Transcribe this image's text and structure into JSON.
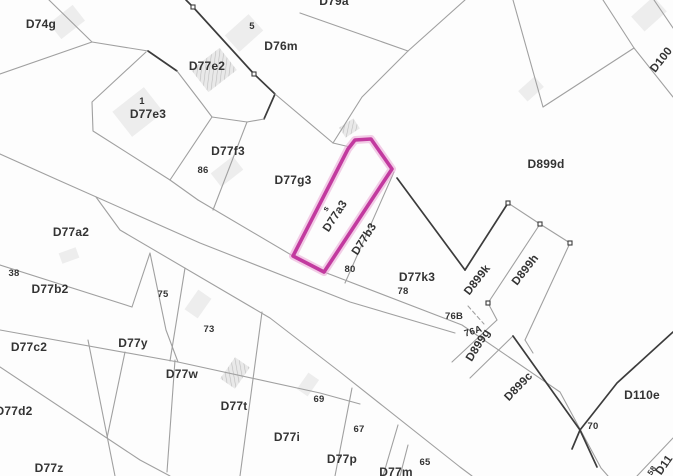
{
  "map": {
    "type": "cadastral-parcel-map",
    "background": "#fdfdfd",
    "line_color": "#a0a0a0",
    "dark_line_color": "#3c3c3c",
    "label_color": "#333333",
    "highlight": {
      "label": "D77a3",
      "stroke": "#c23a9f",
      "halo": "#e9a4d4",
      "points": [
        [
          348,
          149
        ],
        [
          355,
          140
        ],
        [
          371,
          139
        ],
        [
          392,
          169
        ],
        [
          324,
          272
        ],
        [
          293,
          256
        ]
      ]
    },
    "labels": [
      {
        "text": "D74g",
        "x": 41,
        "y": 28,
        "rot": 0,
        "size": 12
      },
      {
        "text": "D79a",
        "x": 334,
        "y": 5,
        "rot": 0,
        "size": 12
      },
      {
        "text": "5",
        "x": 252,
        "y": 29,
        "rot": 0,
        "size": 9.5
      },
      {
        "text": "D76m",
        "x": 281,
        "y": 50,
        "rot": 0,
        "size": 12
      },
      {
        "text": "D77e2",
        "x": 207,
        "y": 70,
        "rot": 0,
        "size": 12
      },
      {
        "text": "1",
        "x": 142,
        "y": 104,
        "rot": 0,
        "size": 9.5
      },
      {
        "text": "D77e3",
        "x": 148,
        "y": 118,
        "rot": 0,
        "size": 12
      },
      {
        "text": "D77f3",
        "x": 228,
        "y": 155,
        "rot": 0,
        "size": 12
      },
      {
        "text": "86",
        "x": 203,
        "y": 173,
        "rot": 0,
        "size": 9.5
      },
      {
        "text": "D77g3",
        "x": 293,
        "y": 184,
        "rot": 0,
        "size": 12
      },
      {
        "text": "D899d",
        "x": 546,
        "y": 168,
        "rot": 0,
        "size": 12
      },
      {
        "text": "D77a2",
        "x": 71,
        "y": 236,
        "rot": 0,
        "size": 12
      },
      {
        "text": "38",
        "x": 14,
        "y": 276,
        "rot": 0,
        "size": 9.5
      },
      {
        "text": "D77b2",
        "x": 50,
        "y": 293,
        "rot": 0,
        "size": 12
      },
      {
        "text": "75",
        "x": 163,
        "y": 297,
        "rot": 0,
        "size": 9.5
      },
      {
        "text": "D77a3",
        "x": 338,
        "y": 218,
        "rot": -57,
        "size": 11.5
      },
      {
        "text": "s",
        "x": 328,
        "y": 210,
        "rot": -57,
        "size": 8
      },
      {
        "text": "D77b3",
        "x": 367,
        "y": 241,
        "rot": -57,
        "size": 11.5
      },
      {
        "text": "80",
        "x": 350,
        "y": 272,
        "rot": 0,
        "size": 9.5
      },
      {
        "text": "D77k3",
        "x": 417,
        "y": 281,
        "rot": 0,
        "size": 12
      },
      {
        "text": "78",
        "x": 403,
        "y": 294,
        "rot": 0,
        "size": 9.5
      },
      {
        "text": "76B",
        "x": 454,
        "y": 319,
        "rot": 0,
        "size": 9.5
      },
      {
        "text": "76A",
        "x": 474,
        "y": 334,
        "rot": -18,
        "size": 9.5
      },
      {
        "text": "D899k",
        "x": 480,
        "y": 282,
        "rot": -52,
        "size": 11.5
      },
      {
        "text": "D899h",
        "x": 528,
        "y": 272,
        "rot": -52,
        "size": 11.5
      },
      {
        "text": "D899g",
        "x": 481,
        "y": 347,
        "rot": -58,
        "size": 11.5
      },
      {
        "text": "D899c",
        "x": 521,
        "y": 389,
        "rot": -46,
        "size": 11.5
      },
      {
        "text": "D100",
        "x": 664,
        "y": 62,
        "rot": -52,
        "size": 11.5
      },
      {
        "text": "D110e",
        "x": 642,
        "y": 399,
        "rot": 0,
        "size": 12
      },
      {
        "text": "70",
        "x": 593,
        "y": 429,
        "rot": 0,
        "size": 9.5
      },
      {
        "text": "D77c2",
        "x": 29,
        "y": 351,
        "rot": 0,
        "size": 12
      },
      {
        "text": "D77y",
        "x": 133,
        "y": 347,
        "rot": 0,
        "size": 12
      },
      {
        "text": "73",
        "x": 209,
        "y": 332,
        "rot": 0,
        "size": 9.5
      },
      {
        "text": "D77w",
        "x": 182,
        "y": 378,
        "rot": 0,
        "size": 12
      },
      {
        "text": "D77t",
        "x": 234,
        "y": 410,
        "rot": 0,
        "size": 12
      },
      {
        "text": "D77d2",
        "x": 14,
        "y": 415,
        "rot": 0,
        "size": 12
      },
      {
        "text": "69",
        "x": 319,
        "y": 402,
        "rot": 0,
        "size": 9.5
      },
      {
        "text": "D77i",
        "x": 287,
        "y": 441,
        "rot": 0,
        "size": 12
      },
      {
        "text": "67",
        "x": 359,
        "y": 432,
        "rot": 0,
        "size": 9.5
      },
      {
        "text": "D77p",
        "x": 342,
        "y": 463,
        "rot": 0,
        "size": 12
      },
      {
        "text": "65",
        "x": 425,
        "y": 465,
        "rot": 0,
        "size": 9.5
      },
      {
        "text": "D77m",
        "x": 396,
        "y": 476,
        "rot": 0,
        "size": 12
      },
      {
        "text": "D77z",
        "x": 49,
        "y": 472,
        "rot": 0,
        "size": 12
      },
      {
        "text": "58",
        "x": 654,
        "y": 472,
        "rot": -55,
        "size": 8
      },
      {
        "text": "D11",
        "x": 667,
        "y": 467,
        "rot": -55,
        "size": 11.5
      }
    ],
    "lines": [
      {
        "pts": [
          [
            49,
            0
          ],
          [
            92,
            42
          ],
          [
            148,
            51
          ]
        ]
      },
      {
        "pts": [
          [
            92,
            42
          ],
          [
            0,
            74
          ]
        ]
      },
      {
        "pts": [
          [
            148,
            51
          ],
          [
            177,
            71
          ]
        ],
        "dark": true
      },
      {
        "pts": [
          [
            177,
            71
          ],
          [
            203,
            105
          ],
          [
            212,
            117
          ]
        ]
      },
      {
        "pts": [
          [
            146,
            52
          ],
          [
            92,
            102
          ],
          [
            93,
            131
          ],
          [
            170,
            180
          ],
          [
            198,
            200
          ]
        ]
      },
      {
        "pts": [
          [
            170,
            180
          ],
          [
            212,
            117
          ]
        ]
      },
      {
        "pts": [
          [
            186,
            0
          ],
          [
            193,
            7
          ],
          [
            254,
            74
          ]
        ],
        "dark": true
      },
      {
        "pts": [
          [
            254,
            74
          ],
          [
            275,
            94
          ],
          [
            264,
            119
          ]
        ],
        "dark": true
      },
      {
        "pts": [
          [
            264,
            119
          ],
          [
            247,
            122
          ],
          [
            212,
            117
          ]
        ]
      },
      {
        "pts": [
          [
            275,
            94
          ],
          [
            333,
            143
          ],
          [
            350,
            147
          ]
        ]
      },
      {
        "pts": [
          [
            300,
            13
          ],
          [
            408,
            51
          ]
        ]
      },
      {
        "pts": [
          [
            465,
            0
          ],
          [
            408,
            51
          ]
        ]
      },
      {
        "pts": [
          [
            408,
            51
          ],
          [
            362,
            97
          ],
          [
            333,
            143
          ]
        ]
      },
      {
        "pts": [
          [
            513,
            0
          ],
          [
            543,
            107
          ]
        ]
      },
      {
        "pts": [
          [
            543,
            107
          ],
          [
            634,
            48
          ]
        ]
      },
      {
        "pts": [
          [
            634,
            48
          ],
          [
            603,
            0
          ]
        ]
      },
      {
        "pts": [
          [
            634,
            48
          ],
          [
            673,
            97
          ]
        ]
      },
      {
        "pts": [
          [
            654,
            0
          ],
          [
            673,
            28
          ]
        ]
      },
      {
        "pts": [
          [
            247,
            122
          ],
          [
            213,
            210
          ]
        ]
      },
      {
        "pts": [
          [
            198,
            200
          ],
          [
            293,
            256
          ],
          [
            324,
            272
          ],
          [
            462,
            325
          ],
          [
            560,
            392
          ],
          [
            601,
            468
          ],
          [
            608,
            476
          ]
        ]
      },
      {
        "pts": [
          [
            0,
            154
          ],
          [
            58,
            180
          ],
          [
            200,
            243
          ],
          [
            350,
            302
          ],
          [
            455,
            333
          ]
        ]
      },
      {
        "pts": [
          [
            96,
            197
          ],
          [
            120,
            230
          ],
          [
            270,
            318
          ],
          [
            340,
            372
          ],
          [
            460,
            467
          ],
          [
            472,
            476
          ]
        ]
      },
      {
        "pts": [
          [
            0,
            265
          ],
          [
            132,
            307
          ]
        ]
      },
      {
        "pts": [
          [
            132,
            307
          ],
          [
            150,
            253
          ],
          [
            166,
            330
          ],
          [
            178,
            362
          ]
        ]
      },
      {
        "pts": [
          [
            0,
            330
          ],
          [
            178,
            362
          ],
          [
            320,
            393
          ],
          [
            360,
            404
          ]
        ]
      },
      {
        "pts": [
          [
            0,
            367
          ],
          [
            140,
            460
          ],
          [
            170,
            476
          ]
        ]
      },
      {
        "pts": [
          [
            88,
            340
          ],
          [
            115,
            476
          ]
        ]
      },
      {
        "pts": [
          [
            185,
            268
          ],
          [
            170,
            361
          ]
        ]
      },
      {
        "pts": [
          [
            125,
            352
          ],
          [
            107,
            438
          ]
        ]
      },
      {
        "pts": [
          [
            175,
            360
          ],
          [
            167,
            472
          ]
        ]
      },
      {
        "pts": [
          [
            262,
            312
          ],
          [
            240,
            476
          ]
        ]
      },
      {
        "pts": [
          [
            352,
            388
          ],
          [
            335,
            476
          ]
        ]
      },
      {
        "pts": [
          [
            398,
            425
          ],
          [
            383,
            476
          ]
        ]
      },
      {
        "pts": [
          [
            408,
            445
          ],
          [
            400,
            476
          ]
        ]
      },
      {
        "pts": [
          [
            394,
            172
          ],
          [
            345,
            283
          ]
        ]
      },
      {
        "pts": [
          [
            397,
            178
          ],
          [
            465,
            270
          ]
        ],
        "dark": true
      },
      {
        "pts": [
          [
            465,
            270
          ],
          [
            508,
            203
          ]
        ],
        "dark": true
      },
      {
        "pts": [
          [
            508,
            203
          ],
          [
            540,
            224
          ],
          [
            570,
            243
          ]
        ]
      },
      {
        "pts": [
          [
            488,
            303
          ],
          [
            540,
            224
          ]
        ]
      },
      {
        "pts": [
          [
            525,
            340
          ],
          [
            570,
            243
          ]
        ]
      },
      {
        "pts": [
          [
            488,
            303
          ],
          [
            497,
            320
          ]
        ]
      },
      {
        "pts": [
          [
            525,
            340
          ],
          [
            533,
            353
          ]
        ]
      },
      {
        "pts": [
          [
            452,
            362
          ],
          [
            497,
            320
          ]
        ]
      },
      {
        "pts": [
          [
            470,
            378
          ],
          [
            513,
            336
          ]
        ]
      },
      {
        "pts": [
          [
            468,
            306
          ],
          [
            484,
            324
          ]
        ],
        "dash": true
      },
      {
        "pts": [
          [
            513,
            336
          ],
          [
            580,
            430
          ]
        ],
        "dark": true
      },
      {
        "pts": [
          [
            580,
            430
          ],
          [
            617,
            383
          ],
          [
            673,
            332
          ]
        ],
        "dark": true
      },
      {
        "pts": [
          [
            572,
            449
          ],
          [
            580,
            430
          ],
          [
            597,
            467
          ]
        ],
        "dark": true
      },
      {
        "pts": [
          [
            637,
            476
          ],
          [
            673,
            438
          ]
        ]
      }
    ],
    "markers": [
      [
        193,
        7
      ],
      [
        254,
        74
      ],
      [
        508,
        203
      ],
      [
        540,
        224
      ],
      [
        570,
        243
      ],
      [
        488,
        303
      ]
    ],
    "buildings": [
      {
        "x": 52,
        "y": 12,
        "w": 30,
        "h": 20,
        "rot": -38,
        "hatched": false
      },
      {
        "x": 118,
        "y": 96,
        "w": 40,
        "h": 32,
        "rot": -38,
        "hatched": false
      },
      {
        "x": 196,
        "y": 56,
        "w": 36,
        "h": 28,
        "rot": -38,
        "hatched": true
      },
      {
        "x": 228,
        "y": 22,
        "w": 32,
        "h": 22,
        "rot": -42,
        "hatched": false
      },
      {
        "x": 341,
        "y": 122,
        "w": 17,
        "h": 12,
        "rot": -33,
        "hatched": true
      },
      {
        "x": 213,
        "y": 163,
        "w": 28,
        "h": 17,
        "rot": -38,
        "hatched": false
      },
      {
        "x": 186,
        "y": 296,
        "w": 24,
        "h": 16,
        "rot": -55,
        "hatched": false
      },
      {
        "x": 222,
        "y": 364,
        "w": 26,
        "h": 18,
        "rot": -55,
        "hatched": true
      },
      {
        "x": 298,
        "y": 378,
        "w": 20,
        "h": 13,
        "rot": -55,
        "hatched": false
      },
      {
        "x": 634,
        "y": 4,
        "w": 30,
        "h": 20,
        "rot": -42,
        "hatched": false
      },
      {
        "x": 520,
        "y": 82,
        "w": 22,
        "h": 14,
        "rot": -42,
        "hatched": false
      },
      {
        "x": 60,
        "y": 250,
        "w": 18,
        "h": 11,
        "rot": -20,
        "hatched": false
      }
    ]
  }
}
